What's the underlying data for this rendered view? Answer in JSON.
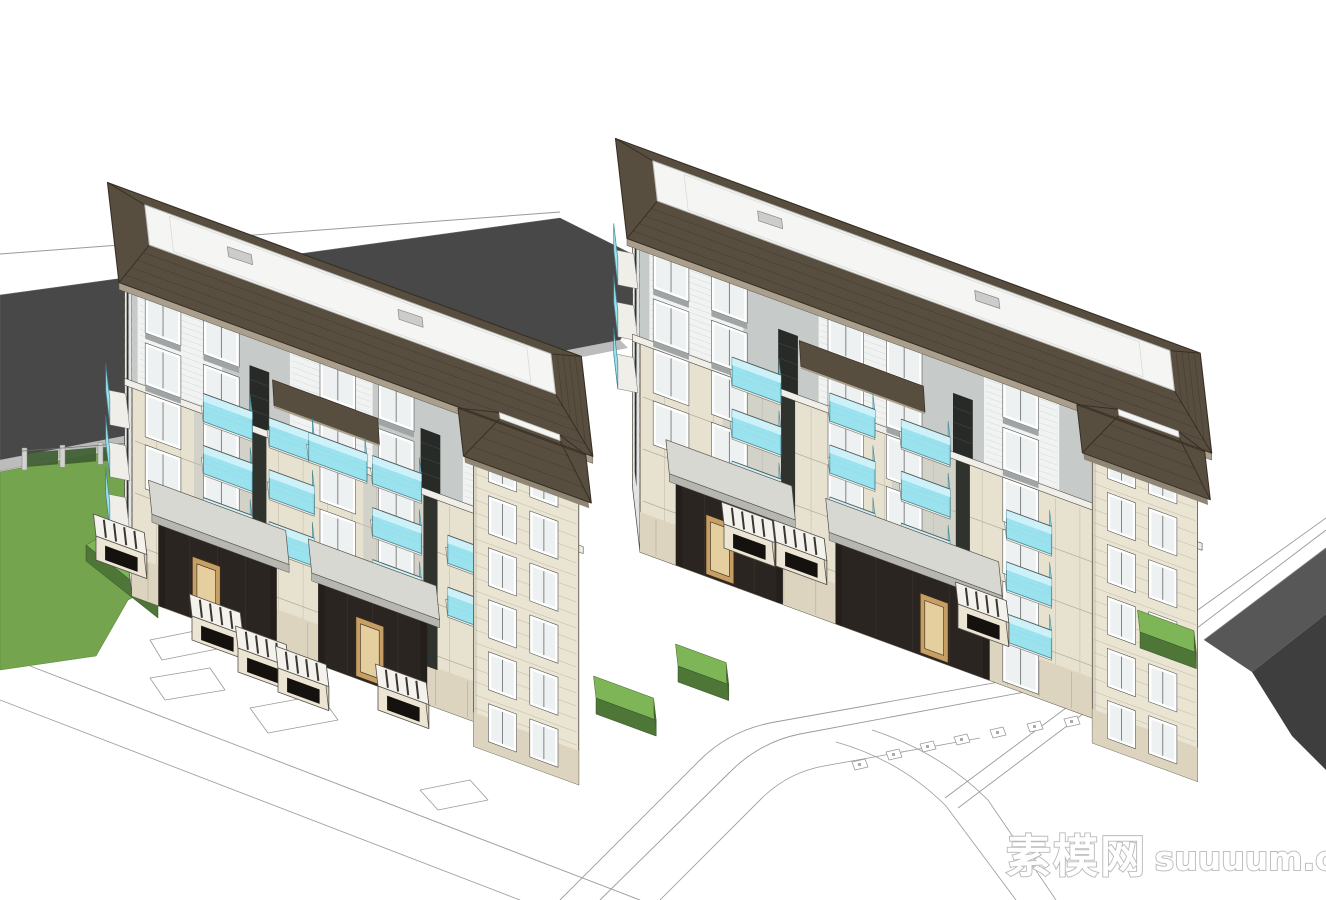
{
  "title": "Residential complex aerial model render",
  "watermark": {
    "cn": "素模网",
    "latin": "suuuum.com"
  },
  "palette": {
    "sky": "#ffffff",
    "bgRoof": "#484848",
    "bgRoofEdge": "#bcbcbc",
    "bgWall": "#d9d9d7",
    "line": "#9a9a9a",
    "stone": "#e7e1cf",
    "stoneShade": "#d6cdb8",
    "stoneJoint": "#b2aa97",
    "base": "#ddd4c0",
    "siding": "#f1f3f2",
    "sidingLine": "#d2d5d5",
    "grayWall": "#c6cac9",
    "grayPanel": "#b7bcbd",
    "darkStrip": "#2f322d",
    "lattice": "#272a26",
    "latticeLine": "#3c403a",
    "glass": "#96e2ef",
    "glassTop": "#d3f3f8",
    "glassSide": "#7fd4e4",
    "glassFrame": "#41808d",
    "winGlass": "#eef1f1",
    "winFrame": "#ffffff",
    "winLine": "#555555",
    "spandrel": "#9fa4a5",
    "slab": "#efeee8",
    "slabEdge": "#777770",
    "canopyTop": "#d8d8d3",
    "canopyEdge": "#b7b7b2",
    "post": "#241f1b",
    "recess": "#2b2521",
    "door": "#c79e63",
    "doorInner": "#e6cf9e",
    "doorFrame": "#33291d",
    "shingle": "#584e40",
    "shingleDark": "#372f25",
    "shingleLine": "#463d31",
    "fascia": "#a99f8c",
    "fasciaDark": "#8f8675",
    "roofWhite": "#f5f5f3",
    "roofRim": "#bfbfbc",
    "skylight": "#cccccb",
    "lawn": "#74a44d",
    "lawnEdge": "#5d8a3e",
    "hedge": "#7db557",
    "hedgeSide": "#4e7637",
    "fencePanel": "#3f5d33",
    "fencePost": "#d2d2d0",
    "road": "#575757",
    "roadDark": "#3e3e3e",
    "outline": "#5a544a",
    "eaveShadow": "rgba(80,74,63,0.40)",
    "boxTop": "#f4f2ec",
    "boxFront": "#ece5d4",
    "boxSide": "#ddd5c1",
    "boxSlat": "#3a352e",
    "boxOpen": "#14110e",
    "wmFill": "#ffffff",
    "wmStroke": "#b5b5b5"
  },
  "scene": {
    "description": "Aerial SketchUp-style render of two six-storey residential apartment buildings with cyan glass balconies, dark brown hip roofs with white flat decks, stone facades, entrance canopies, lawn with fence and hedges, site plan linework, utility boxes and a perimeter road.",
    "buildings": [
      {
        "id": "left-residential-building",
        "floors": 6,
        "entrances": 2,
        "balcony_glass": "cyan",
        "corner_tower": true
      },
      {
        "id": "right-residential-building",
        "floors": 6,
        "entrances": 2,
        "balcony_glass": "cyan",
        "corner_tower": true
      }
    ],
    "landscape": {
      "lawn": true,
      "fence_panels": 5,
      "hedge_walls": 3
    },
    "utility_boxes": 8,
    "skylights_per_roof": 2
  }
}
